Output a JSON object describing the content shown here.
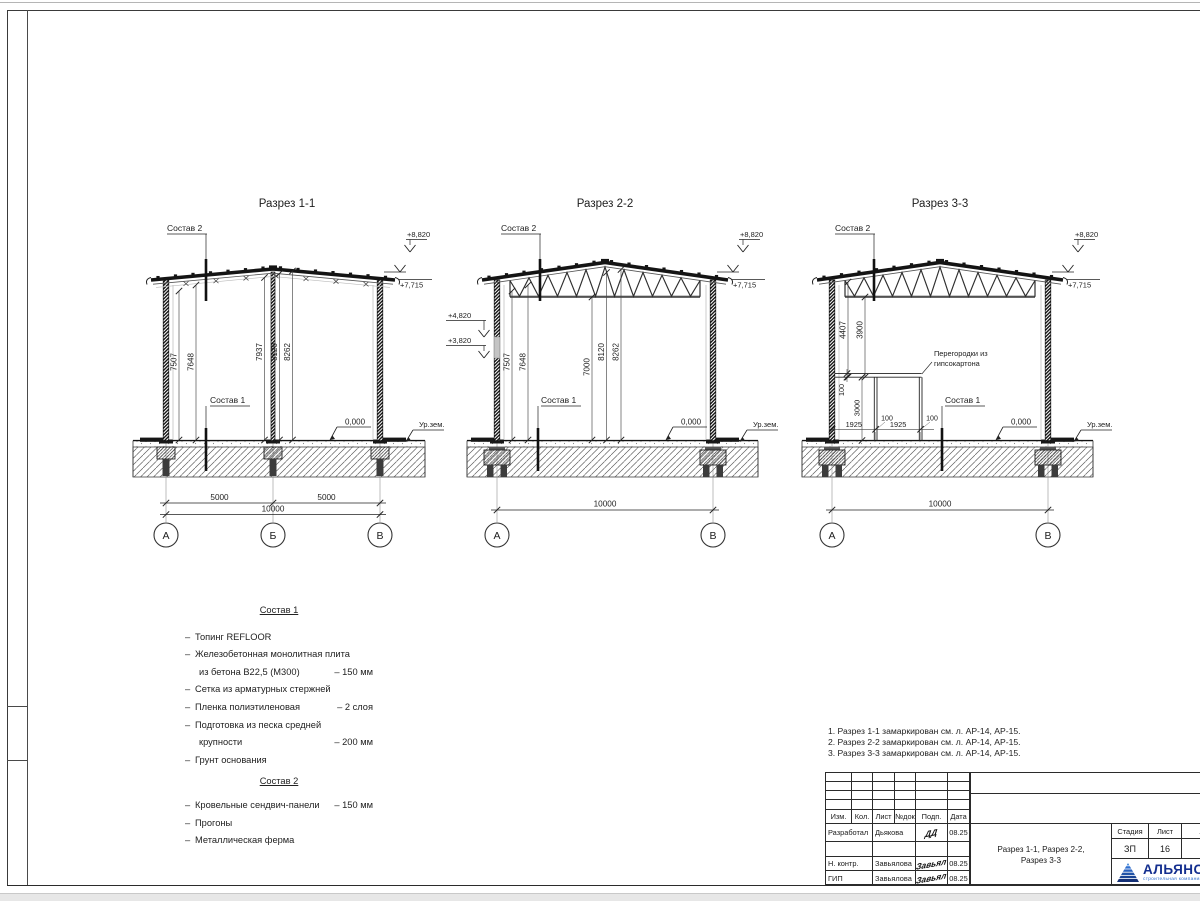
{
  "sections": [
    {
      "title": "Разрез 1-1",
      "sostav2_label": "Состав 2",
      "sostav1_label": "Состав 1",
      "elev_top": "+8,820",
      "elev_eaves": "+7,715",
      "zero_mark": "0,000",
      "ground_mark": "Ур.зем.",
      "dims_left": [
        "7507",
        "7648"
      ],
      "dims_mid": [
        "7937",
        "8120",
        "8262"
      ],
      "span_dims": [
        "5000",
        "5000"
      ],
      "total_dim": "10000",
      "axes": [
        "А",
        "Б",
        "В"
      ]
    },
    {
      "title": "Разрез 2-2",
      "sostav2_label": "Состав 2",
      "sostav1_label": "Состав 1",
      "elev_top": "+8,820",
      "elev_eaves": "+7,715",
      "elev_left": [
        "+4,820",
        "+3,820"
      ],
      "zero_mark": "0,000",
      "ground_mark": "Ур.зем.",
      "dims_left": [
        "7507",
        "7648"
      ],
      "dims_mid": [
        "7000",
        "8120",
        "8262"
      ],
      "total_dim": "10000",
      "axes": [
        "А",
        "В"
      ]
    },
    {
      "title": "Разрез 3-3",
      "sostav2_label": "Состав 2",
      "sostav1_label": "Состав 1",
      "elev_top": "+8,820",
      "elev_eaves": "+7,715",
      "zero_mark": "0,000",
      "ground_mark": "Ур.зем.",
      "dims_left": [
        "4407",
        "3900"
      ],
      "partition": {
        "note": [
          "Перегородки из",
          "гипсокартона"
        ],
        "thickness_top": "100",
        "height": "3000",
        "bay1": "1925",
        "bay2": "1925",
        "t1": "100",
        "t2": "100"
      },
      "total_dim": "10000",
      "axes": [
        "А",
        "В"
      ]
    }
  ],
  "sostav1": {
    "heading": "Состав 1",
    "items": [
      {
        "pre": "–",
        "text": "Топинг REFLOOR",
        "value": ""
      },
      {
        "pre": "–",
        "text": "Железобетонная монолитная плита",
        "value": ""
      },
      {
        "pre": "",
        "text": "из бетона В22,5 (М300)",
        "value": "– 150 мм"
      },
      {
        "pre": "–",
        "text": "Сетка из арматурных стержней",
        "value": ""
      },
      {
        "pre": "–",
        "text": "Пленка полиэтиленовая",
        "value": "– 2 слоя"
      },
      {
        "pre": "–",
        "text": "Подготовка из песка средней",
        "value": ""
      },
      {
        "pre": "",
        "text": "крупности",
        "value": "– 200 мм"
      },
      {
        "pre": "–",
        "text": "Грунт основания",
        "value": ""
      }
    ]
  },
  "sostav2": {
    "heading": "Состав 2",
    "items": [
      {
        "pre": "–",
        "text": "Кровельные сендвич-панели",
        "value": "– 150 мм"
      },
      {
        "pre": "–",
        "text": "Прогоны",
        "value": ""
      },
      {
        "pre": "–",
        "text": "Металлическая ферма",
        "value": ""
      }
    ]
  },
  "notes": [
    "1. Разрез 1-1 замаркирован см. л. АР-14, АР-15.",
    "2. Разрез 2-2 замаркирован см. л. АР-14, АР-15.",
    "3. Разрез 3-3 замаркирован см. л. АР-14, АР-15."
  ],
  "titleblock": {
    "cols": [
      "Изм.",
      "Кол.",
      "Лист",
      "№док",
      "Подп.",
      "Дата"
    ],
    "rows": [
      {
        "role": "Разработал",
        "name": "Дьякова",
        "sig": "ДД",
        "date": "08.25"
      },
      {
        "role": "Н. контр.",
        "name": "Завьялова",
        "sig": "Завьял",
        "date": "08.25"
      },
      {
        "role": "ГИП",
        "name": "Завьялова",
        "sig": "Завьял",
        "date": "08.25"
      }
    ],
    "doc_title_line1": "Разрез 1-1, Разрез 2-2,",
    "doc_title_line2": "Разрез 3-3",
    "stage": {
      "headers": [
        "Стадия",
        "Лист",
        "Листов"
      ],
      "values": [
        "ЗП",
        "16",
        "1"
      ]
    },
    "logo": {
      "name": "АЛЬЯНС",
      "subtitle": "строительная компания",
      "color": "#142f8f",
      "accent": "#2f6fd0"
    }
  }
}
